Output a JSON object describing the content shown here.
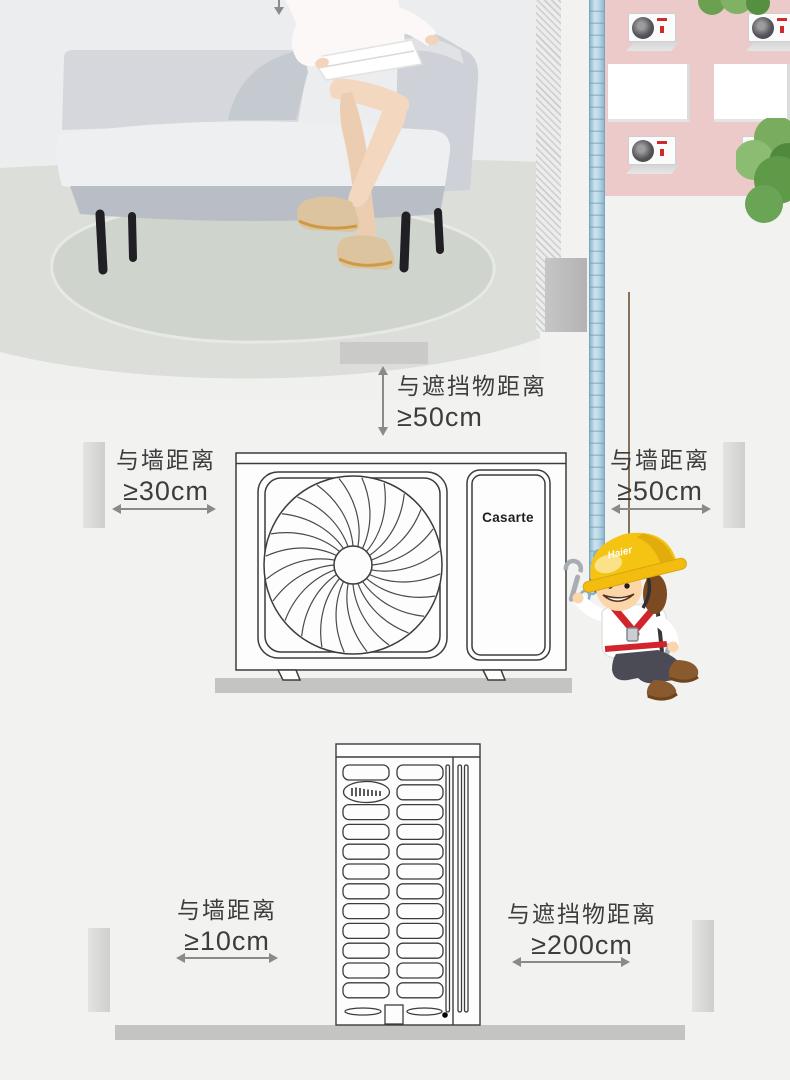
{
  "labels": {
    "top_clearance": {
      "line1": "与遮挡物距离",
      "line2": "≥50cm"
    },
    "mid_left_wall": {
      "line1": "与墙距离",
      "line2": "≥30cm"
    },
    "mid_right_wall": {
      "line1": "与墙距离",
      "line2": "≥50cm"
    },
    "bottom_left_wall": {
      "line1": "与墙距离",
      "line2": "≥10cm"
    },
    "bottom_right_clearance": {
      "line1": "与遮挡物距离",
      "line2": "≥200cm"
    }
  },
  "branding": {
    "outdoor_unit_logo": "Casarte",
    "helmet_logo": "Haier"
  },
  "colors": {
    "page_background": "#f2f2f1",
    "annotation_text": "#3d3d3d",
    "arrow_gray": "#8a8a8a",
    "ground_gray": "#c4c4c3",
    "building_pink": "#eccaca",
    "pipe_blue": "#b9d7e7",
    "tree_green": "#79ac5e",
    "helmet_yellow": "#f5c413",
    "harness_red": "#d2242b",
    "boot_brown": "#8a5a2f",
    "sofa_gray": "#d5d7dc",
    "diagram_line": "#3c3c3c"
  },
  "icons": {
    "down_arrow": "down-arrow-icon",
    "double_arrow_horizontal": "double-arrow-h-icon",
    "double_arrow_vertical": "double-arrow-v-icon",
    "wrench": "wrench-icon",
    "chain": "chain-links-icon"
  }
}
